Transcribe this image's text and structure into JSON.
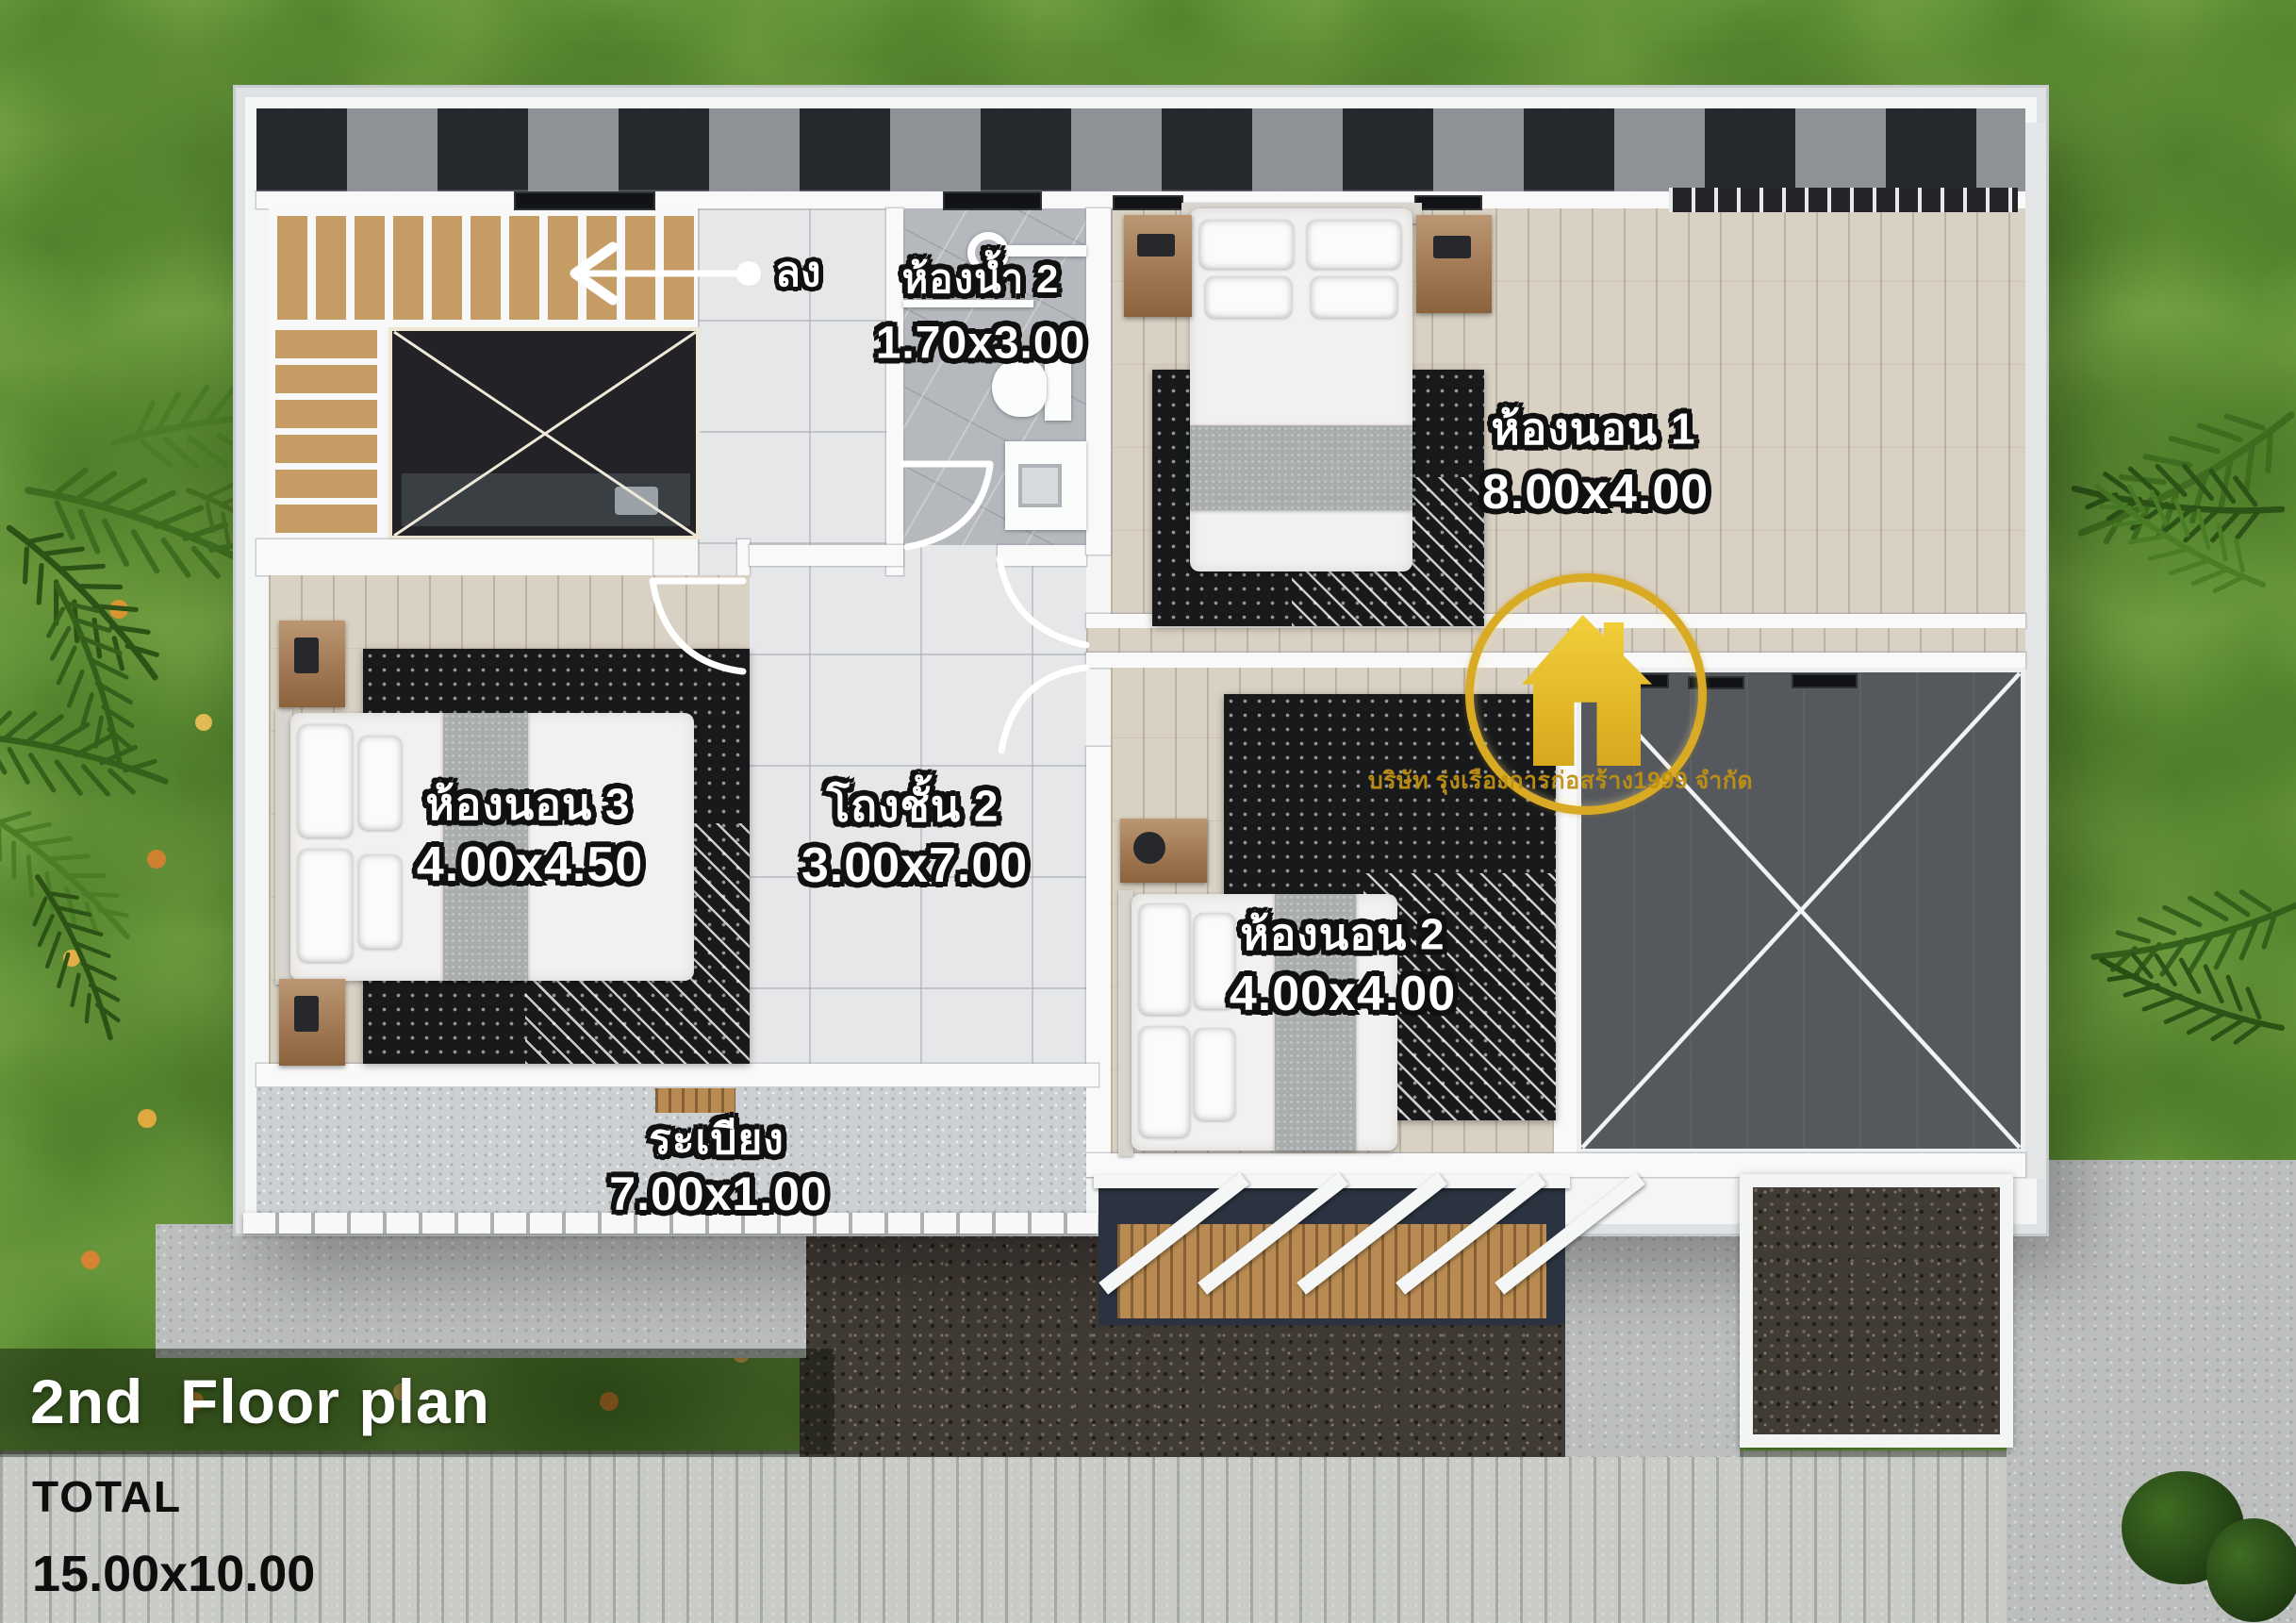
{
  "title": {
    "heading": "2nd  Floor plan",
    "total_label": "TOTAL",
    "total_value": "15.00x10.00"
  },
  "rooms": {
    "bathroom2": {
      "name": "ห้องน้ำ 2",
      "size": "1.70x3.00"
    },
    "bedroom1": {
      "name": "ห้องนอน 1",
      "size": "8.00x4.00"
    },
    "bedroom3": {
      "name": "ห้องนอน 3",
      "size": "4.00x4.50"
    },
    "hall2": {
      "name": "โถงชั้น 2",
      "size": "3.00x7.00"
    },
    "bedroom2": {
      "name": "ห้องนอน 2",
      "size": "4.00x4.00"
    },
    "balcony": {
      "name": "ระเบียง",
      "size": "7.00x1.00"
    }
  },
  "annotations": {
    "stairs_down": "ลง"
  },
  "logo": {
    "company_text": "บริษัท รุ่งเรืองการก่อสร้าง1999 จำกัด"
  },
  "colors": {
    "grass": "#68963a",
    "wall_white": "#f9f9f9",
    "tile_dark": "#2f3237",
    "wood_floor": "#d9d1c3",
    "open_void_gray": "#55585d",
    "gravel_dark": "#413b35",
    "gold_logo": "#d9ab25",
    "label_fill": "#ffffff",
    "label_outline": "#101010"
  }
}
